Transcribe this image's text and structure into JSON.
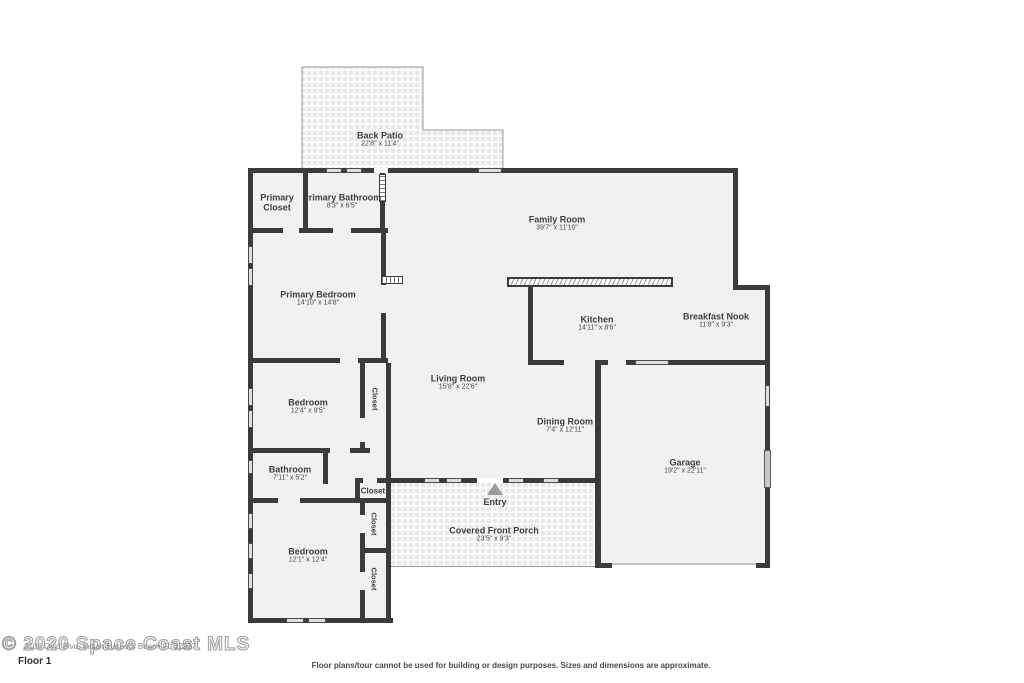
{
  "floorplan": {
    "title": "Floor 1",
    "rooms": [
      {
        "name": "Back Patio",
        "dims": "22'8\" x 11'4\""
      },
      {
        "name": "Primary Closet",
        "dims": ""
      },
      {
        "name": "Primary Bathroom",
        "dims": "8'3\" x 6'5\""
      },
      {
        "name": "Family Room",
        "dims": "39'7\" x 11'10\""
      },
      {
        "name": "Primary Bedroom",
        "dims": "14'10\" x 14'8\""
      },
      {
        "name": "Kitchen",
        "dims": "14'11\" x 8'6\""
      },
      {
        "name": "Breakfast Nook",
        "dims": "11'8\" x 9'3\""
      },
      {
        "name": "Living Room",
        "dims": "15'8\" x 22'6\""
      },
      {
        "name": "Bedroom",
        "dims": "12'4\" x 9'5\""
      },
      {
        "name": "Dining Room",
        "dims": "7'4\" x 12'11\""
      },
      {
        "name": "Bathroom",
        "dims": "7'11\" x 5'2\""
      },
      {
        "name": "Garage",
        "dims": "19'2\" x 22'11\""
      },
      {
        "name": "Entry",
        "dims": ""
      },
      {
        "name": "Covered Front Porch",
        "dims": "23'5\" x 9'3\""
      },
      {
        "name": "Bedroom",
        "dims": "12'1\" x 12'4\""
      }
    ],
    "closets": [
      "Closet",
      "Closet",
      "Closet",
      "Closet"
    ]
  },
  "footer": {
    "watermark": "© 2020 Space Coast MLS",
    "address_watermark": "2106 Ovid Blvd, Indian Harbour Beach FL 32937",
    "floor_label": "Floor 1",
    "disclaimer": "Floor plans/tour cannot be used for building or design purposes. Sizes and dimensions are approximate."
  },
  "colors": {
    "wall": "#3b3b3b",
    "room_fill": "#f1f1f1",
    "window_fill": "#dedede",
    "text": "#3d3d3d",
    "paver_outline": "#9a9a9a"
  }
}
